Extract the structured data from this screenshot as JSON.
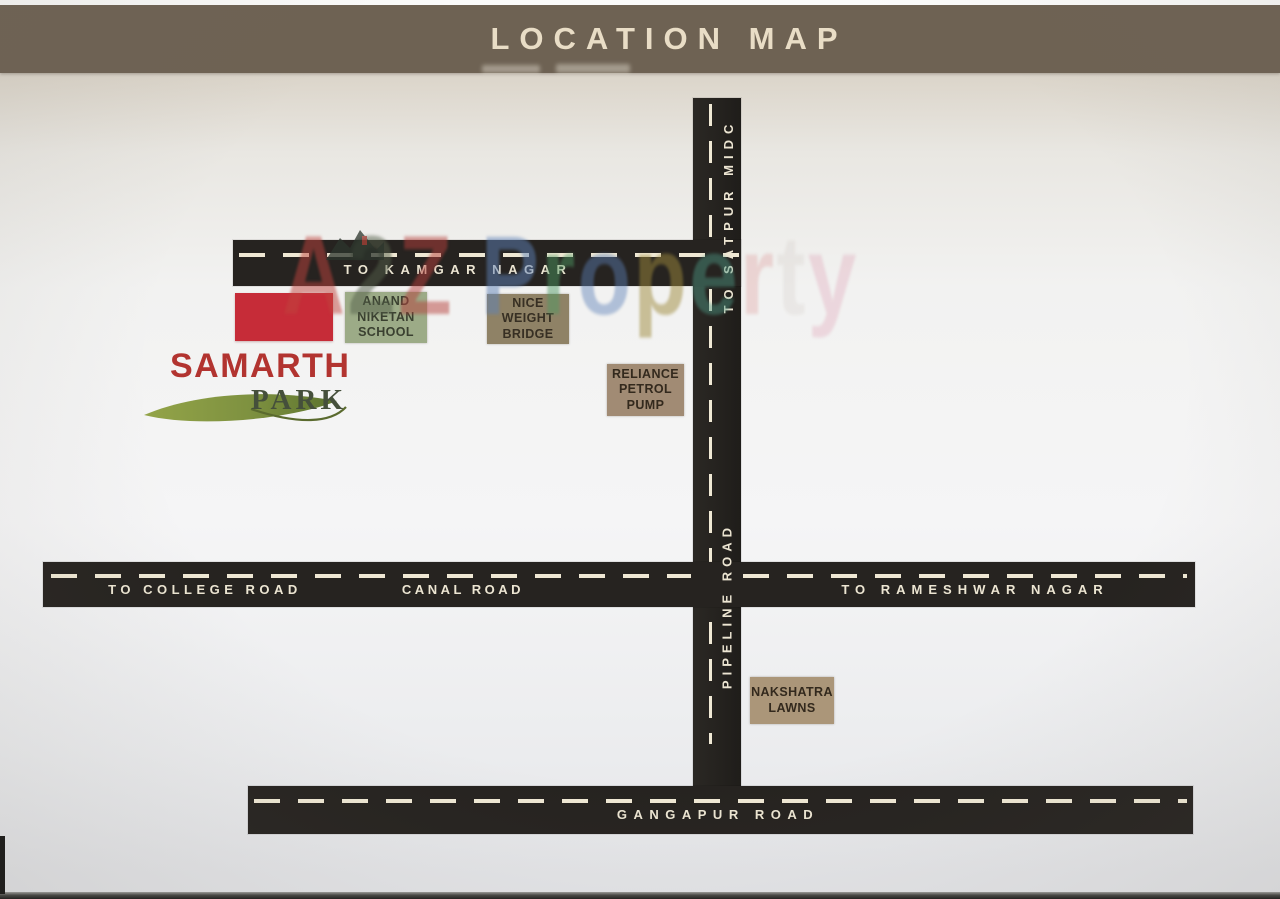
{
  "header": {
    "title": "LOCATION MAP"
  },
  "watermark": {
    "text": "A2Z Property",
    "letters": [
      {
        "ch": "A",
        "color": "#c0453e",
        "opacity": 0.5
      },
      {
        "ch": "2",
        "color": "#55604a",
        "opacity": 0.5
      },
      {
        "ch": "Z",
        "color": "#b5403c",
        "opacity": 0.5
      },
      {
        "ch": " ",
        "color": "#000000",
        "opacity": 0
      },
      {
        "ch": "P",
        "color": "#5e82b8",
        "opacity": 0.5
      },
      {
        "ch": "r",
        "color": "#4f9a63",
        "opacity": 0.48
      },
      {
        "ch": "o",
        "color": "#5e82b8",
        "opacity": 0.45
      },
      {
        "ch": "p",
        "color": "#9d8a3c",
        "opacity": 0.5
      },
      {
        "ch": "e",
        "color": "#4f9a85",
        "opacity": 0.45
      },
      {
        "ch": "r",
        "color": "#d9908e",
        "opacity": 0.3
      },
      {
        "ch": "t",
        "color": "#b8b0a8",
        "opacity": 0.16
      },
      {
        "ch": "y",
        "color": "#d990a8",
        "opacity": 0.28
      }
    ]
  },
  "roads": {
    "kamgar": {
      "label": "TO KAMGAR NAGAR"
    },
    "satpur": {
      "label": "TO SATPUR MIDC"
    },
    "pipeline": {
      "label": "PIPELINE ROAD"
    },
    "college": {
      "label": "TO COLLEGE ROAD"
    },
    "canal": {
      "label": "CANAL ROAD"
    },
    "rameshwar": {
      "label": "TO RAMESHWAR NAGAR"
    },
    "gangapur": {
      "label": "GANGAPUR ROAD"
    }
  },
  "landmarks": [
    {
      "name": "Anand Niketan School",
      "lines": [
        "ANAND",
        "NIKETAN",
        "SCHOOL"
      ],
      "bg": "#9cab87",
      "fg": "#3a4030"
    },
    {
      "name": "Nice Weight Bridge",
      "lines": [
        "NICE",
        "WEIGHT",
        "BRIDGE"
      ],
      "bg": "#8f8266",
      "fg": "#372f23"
    },
    {
      "name": "Reliance Petrol Pump",
      "lines": [
        "RELIANCE",
        "PETROL",
        "PUMP"
      ],
      "bg": "#a18b74",
      "fg": "#33291d"
    },
    {
      "name": "Nakshatra Lawns",
      "lines": [
        "NAKSHATRA",
        "LAWNS"
      ],
      "bg": "#ab9679",
      "fg": "#33291d"
    }
  ],
  "project": {
    "name_line1": "SAMARTH",
    "name_line2": "PARK",
    "marker_color": "#c62c38",
    "name_color": "#b23430",
    "park_color": "#454f3b"
  },
  "colors": {
    "header_bg": "#6e6253",
    "header_text": "#e9ddc6",
    "road": "#262320",
    "dash": "#efe8d4",
    "road_text": "#ece5d2"
  }
}
